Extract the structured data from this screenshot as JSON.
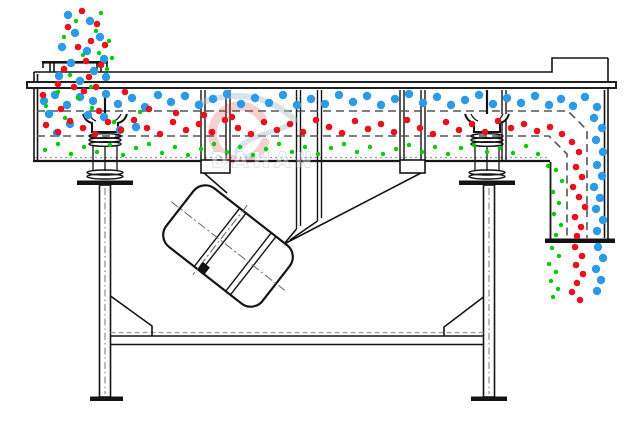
{
  "watermark": {
    "brand": "DAHAN",
    "registered_mark": "®"
  },
  "colors": {
    "oversize_blue": "#2B9BE8",
    "medium_red": "#E8121E",
    "fines_green": "#00CC00",
    "line": "#141414",
    "deck_dash": "#555555",
    "watermark_swoosh": "#A9BFD4",
    "watermark_red": "#D24040"
  },
  "particles": {
    "streams": [
      {
        "name": "feed-stream-oversize",
        "color": "#2B9BE8",
        "radius": 4.2,
        "points": [
          [
            68,
            15
          ],
          [
            90,
            21
          ],
          [
            75,
            33
          ],
          [
            100,
            37
          ],
          [
            62,
            47
          ],
          [
            87,
            51
          ],
          [
            104,
            59
          ],
          [
            71,
            63
          ],
          [
            94,
            71
          ],
          [
            80,
            81
          ],
          [
            106,
            77
          ],
          [
            59,
            76
          ]
        ]
      },
      {
        "name": "feed-stream-medium",
        "color": "#E8121E",
        "radius": 3.3,
        "points": [
          [
            82,
            11
          ],
          [
            97,
            24
          ],
          [
            68,
            27
          ],
          [
            91,
            41
          ],
          [
            78,
            47
          ],
          [
            105,
            45
          ],
          [
            86,
            61
          ],
          [
            64,
            69
          ],
          [
            101,
            65
          ],
          [
            89,
            77
          ],
          [
            58,
            84
          ],
          [
            74,
            87
          ],
          [
            96,
            87
          ]
        ]
      },
      {
        "name": "feed-stream-fines",
        "color": "#00CC00",
        "radius": 2.2,
        "points": [
          [
            101,
            13
          ],
          [
            76,
            21
          ],
          [
            96,
            31
          ],
          [
            64,
            37
          ],
          [
            109,
            41
          ],
          [
            83,
            55
          ],
          [
            99,
            53
          ],
          [
            70,
            75
          ],
          [
            107,
            69
          ],
          [
            91,
            87
          ],
          [
            112,
            58
          ]
        ]
      },
      {
        "name": "top-deck-oversize",
        "color": "#2B9BE8",
        "radius": 4.2,
        "points": [
          [
            44,
            101
          ],
          [
            55,
            95
          ],
          [
            67,
            105
          ],
          [
            80,
            97
          ],
          [
            93,
            101
          ],
          [
            106,
            94
          ],
          [
            118,
            104
          ],
          [
            132,
            98
          ],
          [
            145,
            107
          ],
          [
            158,
            95
          ],
          [
            171,
            102
          ],
          [
            185,
            96
          ],
          [
            199,
            105
          ],
          [
            213,
            99
          ],
          [
            227,
            94
          ],
          [
            241,
            104
          ],
          [
            255,
            98
          ],
          [
            269,
            103
          ],
          [
            283,
            95
          ],
          [
            297,
            105
          ],
          [
            311,
            99
          ],
          [
            325,
            104
          ],
          [
            339,
            95
          ],
          [
            353,
            102
          ],
          [
            367,
            96
          ],
          [
            381,
            105
          ],
          [
            395,
            99
          ],
          [
            409,
            94
          ],
          [
            423,
            103
          ],
          [
            437,
            97
          ],
          [
            451,
            105
          ],
          [
            465,
            100
          ],
          [
            479,
            95
          ],
          [
            493,
            104
          ],
          [
            507,
            98
          ],
          [
            521,
            103
          ],
          [
            535,
            96
          ],
          [
            549,
            105
          ],
          [
            561,
            99
          ],
          [
            573,
            106
          ],
          [
            585,
            97
          ],
          [
            597,
            107
          ]
        ]
      },
      {
        "name": "mixed-zone-oversize",
        "color": "#2B9BE8",
        "radius": 4.2,
        "points": [
          [
            49,
            114
          ],
          [
            70,
            124
          ],
          [
            104,
            117
          ],
          [
            136,
            127
          ],
          [
            57,
            133
          ],
          [
            88,
            115
          ],
          [
            120,
            130
          ]
        ]
      },
      {
        "name": "mixed-zone-medium",
        "color": "#E8121E",
        "radius": 3.3,
        "points": [
          [
            43,
            95
          ],
          [
            61,
            109
          ],
          [
            84,
            91
          ],
          [
            99,
            111
          ],
          [
            125,
            92
          ],
          [
            149,
            109
          ],
          [
            176,
            113
          ],
          [
            204,
            115
          ],
          [
            232,
            117
          ]
        ]
      },
      {
        "name": "mixed-zone-fines",
        "color": "#00CC00",
        "radius": 2.2,
        "points": [
          [
            46,
            106
          ],
          [
            65,
            118
          ],
          [
            92,
            108
          ],
          [
            114,
            122
          ],
          [
            140,
            112
          ],
          [
            78,
            98
          ],
          [
            58,
            92
          ]
        ]
      },
      {
        "name": "middle-deck-medium",
        "color": "#E8121E",
        "radius": 3.3,
        "points": [
          [
            46,
            125
          ],
          [
            58,
            132
          ],
          [
            70,
            121
          ],
          [
            83,
            128
          ],
          [
            95,
            134
          ],
          [
            108,
            122
          ],
          [
            121,
            130
          ],
          [
            134,
            120
          ],
          [
            147,
            128
          ],
          [
            160,
            134
          ],
          [
            173,
            122
          ],
          [
            186,
            130
          ],
          [
            199,
            124
          ],
          [
            212,
            132
          ],
          [
            225,
            120
          ],
          [
            238,
            128
          ],
          [
            251,
            134
          ],
          [
            264,
            122
          ],
          [
            277,
            130
          ],
          [
            290,
            124
          ],
          [
            303,
            132
          ],
          [
            316,
            120
          ],
          [
            329,
            127
          ],
          [
            342,
            133
          ],
          [
            355,
            121
          ],
          [
            368,
            129
          ],
          [
            381,
            124
          ],
          [
            394,
            132
          ],
          [
            407,
            120
          ],
          [
            420,
            128
          ],
          [
            433,
            134
          ],
          [
            446,
            122
          ],
          [
            459,
            130
          ],
          [
            472,
            124
          ],
          [
            485,
            132
          ],
          [
            498,
            121
          ],
          [
            511,
            128
          ],
          [
            524,
            124
          ],
          [
            537,
            131
          ],
          [
            550,
            127
          ],
          [
            562,
            134
          ],
          [
            572,
            142
          ],
          [
            579,
            152
          ]
        ]
      },
      {
        "name": "bottom-deck-fines",
        "color": "#00CC00",
        "radius": 2.2,
        "points": [
          [
            45,
            150
          ],
          [
            58,
            144
          ],
          [
            71,
            154
          ],
          [
            84,
            147
          ],
          [
            97,
            152
          ],
          [
            110,
            145
          ],
          [
            123,
            155
          ],
          [
            136,
            148
          ],
          [
            149,
            144
          ],
          [
            162,
            153
          ],
          [
            175,
            147
          ],
          [
            188,
            155
          ],
          [
            201,
            149
          ],
          [
            214,
            144
          ],
          [
            227,
            152
          ],
          [
            240,
            147
          ],
          [
            253,
            155
          ],
          [
            266,
            149
          ],
          [
            279,
            144
          ],
          [
            292,
            152
          ],
          [
            305,
            147
          ],
          [
            318,
            154
          ],
          [
            331,
            148
          ],
          [
            344,
            144
          ],
          [
            357,
            152
          ],
          [
            370,
            147
          ],
          [
            383,
            154
          ],
          [
            396,
            149
          ],
          [
            409,
            145
          ],
          [
            422,
            152
          ],
          [
            435,
            147
          ],
          [
            448,
            154
          ],
          [
            461,
            148
          ],
          [
            474,
            145
          ],
          [
            487,
            152
          ],
          [
            500,
            148
          ],
          [
            513,
            153
          ],
          [
            526,
            146
          ],
          [
            538,
            154
          ]
        ]
      },
      {
        "name": "chute-oversize",
        "color": "#2B9BE8",
        "radius": 4.2,
        "points": [
          [
            594,
            118
          ],
          [
            602,
            128
          ],
          [
            596,
            140
          ],
          [
            603,
            152
          ],
          [
            597,
            165
          ],
          [
            602,
            176
          ],
          [
            594,
            187
          ],
          [
            600,
            198
          ],
          [
            596,
            209
          ],
          [
            603,
            220
          ],
          [
            597,
            231
          ]
        ]
      },
      {
        "name": "chute-medium",
        "color": "#E8121E",
        "radius": 3.3,
        "points": [
          [
            576,
            167
          ],
          [
            582,
            177
          ],
          [
            573,
            187
          ],
          [
            579,
            197
          ],
          [
            585,
            207
          ],
          [
            575,
            217
          ],
          [
            581,
            227
          ],
          [
            577,
            236
          ]
        ]
      },
      {
        "name": "chute-fines",
        "color": "#00CC00",
        "radius": 2.2,
        "points": [
          [
            548,
            166
          ],
          [
            556,
            170
          ],
          [
            562,
            181
          ],
          [
            553,
            192
          ],
          [
            559,
            203
          ],
          [
            554,
            214
          ],
          [
            561,
            225
          ],
          [
            556,
            235
          ]
        ]
      },
      {
        "name": "discharge-falling-oversize",
        "color": "#2B9BE8",
        "radius": 4.2,
        "points": [
          [
            598,
            247
          ],
          [
            603,
            258
          ],
          [
            596,
            269
          ],
          [
            601,
            280
          ],
          [
            597,
            291
          ]
        ]
      },
      {
        "name": "discharge-falling-medium",
        "color": "#E8121E",
        "radius": 3.3,
        "points": [
          [
            575,
            247
          ],
          [
            582,
            256
          ],
          [
            576,
            265
          ],
          [
            583,
            274
          ],
          [
            577,
            283
          ],
          [
            572,
            292
          ],
          [
            580,
            300
          ]
        ]
      },
      {
        "name": "discharge-falling-fines",
        "color": "#00CC00",
        "radius": 2.2,
        "points": [
          [
            552,
            248
          ],
          [
            559,
            256
          ],
          [
            549,
            264
          ],
          [
            556,
            272
          ],
          [
            551,
            281
          ],
          [
            558,
            289
          ],
          [
            553,
            297
          ]
        ]
      }
    ]
  }
}
